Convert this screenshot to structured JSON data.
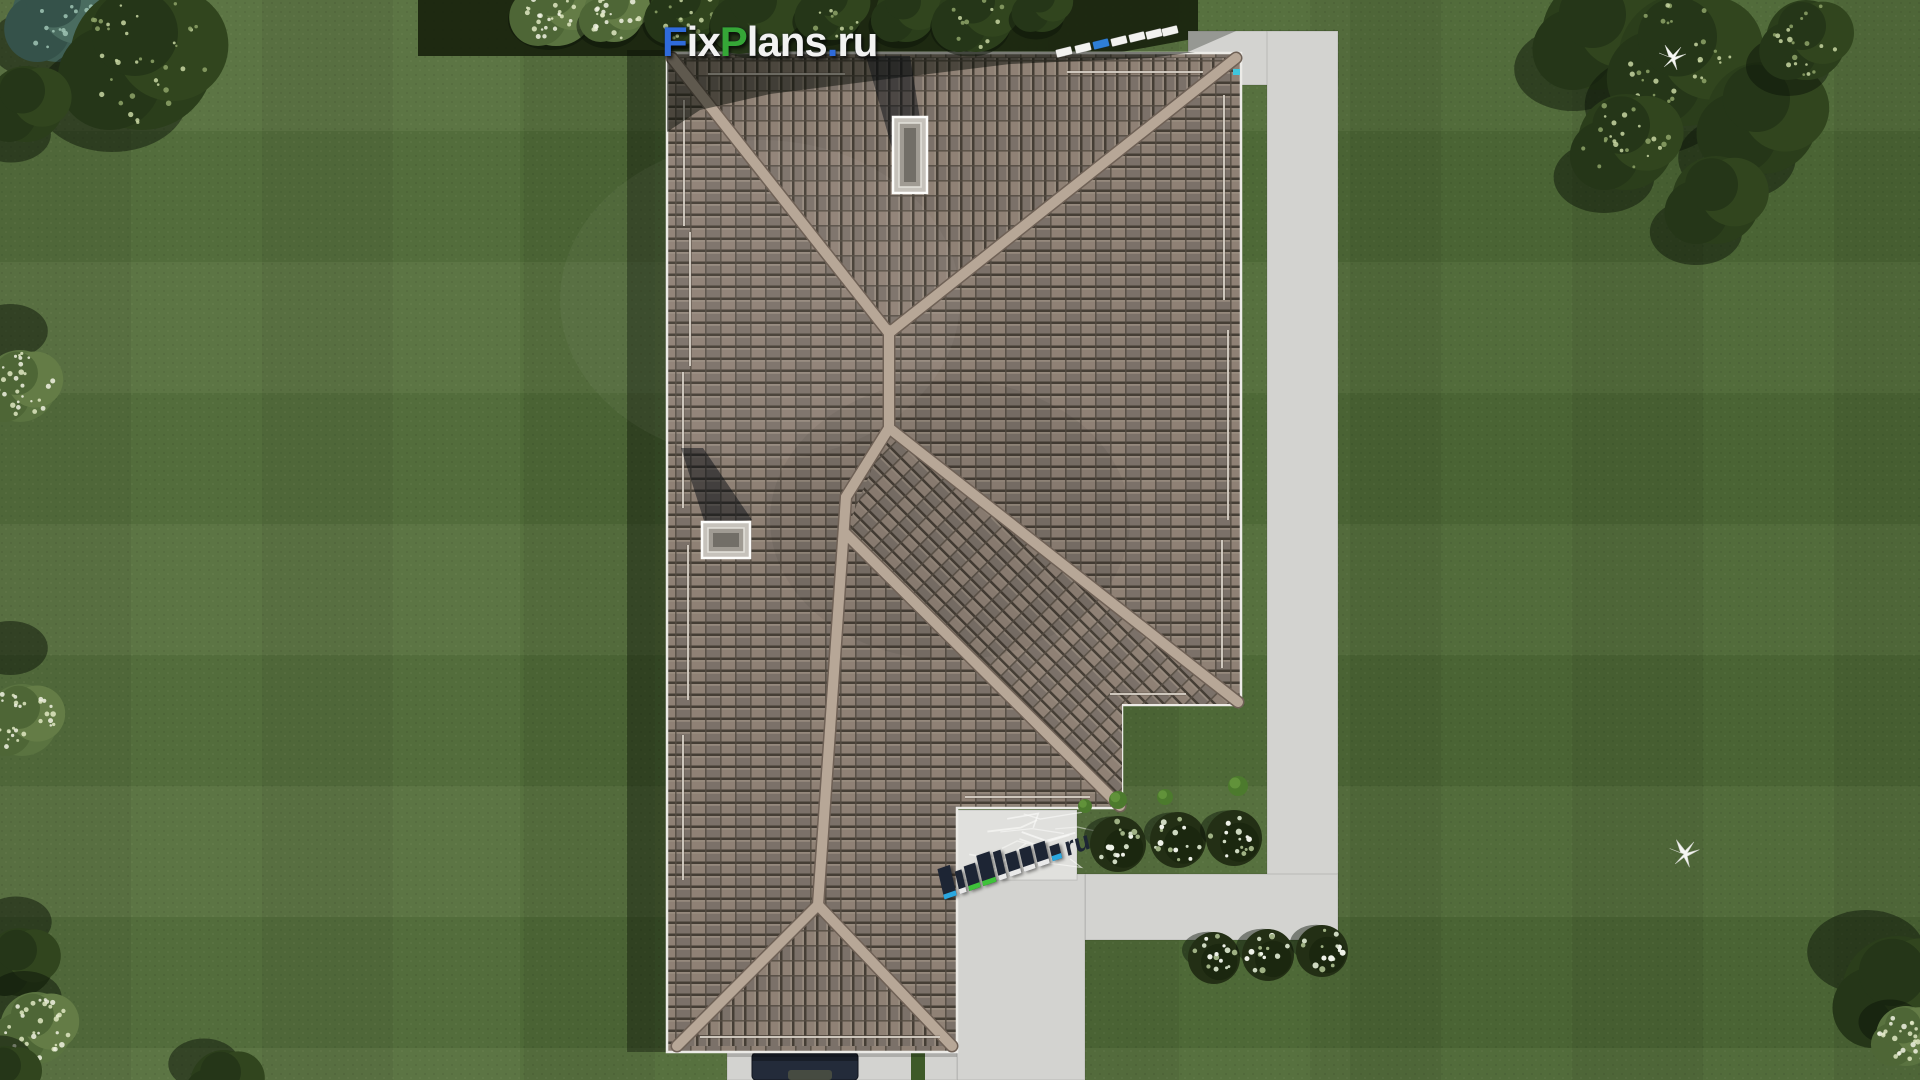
{
  "watermark_top": {
    "part_f": "F",
    "part_ix": "ix",
    "part_p": "P",
    "part_lans": "lans",
    "part_dot": ".",
    "part_ru": "ru"
  },
  "watermark_bottom": {
    "label": "FixPlans.ru",
    "ru_label": "ru"
  },
  "palette": {
    "wm_blue": "#2f6bdb",
    "wm_green": "#35a637",
    "wm_white": "#f2f2f2",
    "wm3_navy": "#1d2534",
    "wm3_cyan": "#2aa7e0",
    "wm3_green": "#3fc23a",
    "grass": "#4e6937",
    "grass_shadow_band": "#1a250f",
    "concrete": "#d3d3d0",
    "terrace": "#e0e0dd",
    "roof_tile": "#87796d",
    "ridge": "#b7a797",
    "fascia": "#ecebe7",
    "chimney": "#c6c2bb",
    "car": "#232b3a",
    "hedge": "#3e5a28"
  },
  "scene": {
    "trees": [
      {
        "x": 58,
        "y": 16,
        "r": 46,
        "t": "teal",
        "sdx": -20,
        "sdy": 28
      },
      {
        "x": 142,
        "y": 58,
        "r": 72,
        "t": "darkspeck",
        "sdx": -30,
        "sdy": 40
      },
      {
        "x": 26,
        "y": 104,
        "r": 38,
        "t": "dark",
        "sdx": -15,
        "sdy": 30
      },
      {
        "x": 556,
        "y": 6,
        "r": 40,
        "t": "speck",
        "sdx": -6,
        "sdy": 14
      },
      {
        "x": 614,
        "y": 12,
        "r": 30,
        "t": "speck",
        "sdx": -6,
        "sdy": 14
      },
      {
        "x": 684,
        "y": 10,
        "r": 34,
        "t": "darkspeck",
        "sdx": -6,
        "sdy": 14
      },
      {
        "x": 757,
        "y": 14,
        "r": 40,
        "t": "dark",
        "sdx": -6,
        "sdy": 14
      },
      {
        "x": 832,
        "y": 8,
        "r": 32,
        "t": "darkspeck",
        "sdx": -6,
        "sdy": 14
      },
      {
        "x": 906,
        "y": 12,
        "r": 30,
        "t": "dark",
        "sdx": -6,
        "sdy": 14
      },
      {
        "x": 976,
        "y": 14,
        "r": 38,
        "t": "darkspeck",
        "sdx": -6,
        "sdy": 14
      },
      {
        "x": 1042,
        "y": 6,
        "r": 26,
        "t": "dark",
        "sdx": -6,
        "sdy": 14
      },
      {
        "x": 1598,
        "y": 34,
        "r": 56,
        "t": "dark",
        "sdx": -25,
        "sdy": 35
      },
      {
        "x": 1684,
        "y": 60,
        "r": 66,
        "t": "darkspeck",
        "sdx": -30,
        "sdy": 45
      },
      {
        "x": 1762,
        "y": 118,
        "r": 56,
        "t": "dark",
        "sdx": -25,
        "sdy": 40
      },
      {
        "x": 1626,
        "y": 142,
        "r": 48,
        "t": "darkspeck",
        "sdx": -22,
        "sdy": 35
      },
      {
        "x": 1716,
        "y": 200,
        "r": 44,
        "t": "dark",
        "sdx": -20,
        "sdy": 32
      },
      {
        "x": 1806,
        "y": 40,
        "r": 40,
        "t": "darkspeck",
        "sdx": -18,
        "sdy": 26
      },
      {
        "x": 20,
        "y": 386,
        "r": 36,
        "t": "speck",
        "sdx": -10,
        "sdy": -55
      },
      {
        "x": 22,
        "y": 720,
        "r": 36,
        "t": "speck",
        "sdx": -12,
        "sdy": -72
      },
      {
        "x": 20,
        "y": 962,
        "r": 34,
        "t": "dark",
        "sdx": -4,
        "sdy": -40
      },
      {
        "x": 36,
        "y": 1028,
        "r": 36,
        "t": "speck",
        "sdx": -12,
        "sdy": -30
      },
      {
        "x": 6,
        "y": 1076,
        "r": 30,
        "t": "dark",
        "sdx": -6,
        "sdy": -18
      },
      {
        "x": 224,
        "y": 1084,
        "r": 34,
        "t": "dark",
        "sdx": -20,
        "sdy": -20
      },
      {
        "x": 1898,
        "y": 992,
        "r": 56,
        "t": "dark",
        "sdx": -32,
        "sdy": -40
      },
      {
        "x": 1906,
        "y": 1036,
        "r": 30,
        "t": "speck",
        "sdx": -16,
        "sdy": -14
      }
    ],
    "flower_bushes": [
      {
        "x": 1118,
        "y": 844,
        "r": 28
      },
      {
        "x": 1178,
        "y": 840,
        "r": 28
      },
      {
        "x": 1234,
        "y": 838,
        "r": 28
      },
      {
        "x": 1214,
        "y": 958,
        "r": 26
      },
      {
        "x": 1268,
        "y": 955,
        "r": 26
      },
      {
        "x": 1322,
        "y": 951,
        "r": 26
      }
    ],
    "grass_tufts": [
      {
        "x": 1085,
        "y": 806,
        "r": 7
      },
      {
        "x": 1118,
        "y": 800,
        "r": 9
      },
      {
        "x": 1165,
        "y": 797,
        "r": 8
      },
      {
        "x": 1238,
        "y": 786,
        "r": 10
      }
    ],
    "birds": [
      {
        "x": 1672,
        "y": 58,
        "s": 1.0
      },
      {
        "x": 1684,
        "y": 854,
        "s": 1.1
      }
    ],
    "roof_slabs_watermark": [
      {
        "x": 1056,
        "y": 48,
        "c": "white"
      },
      {
        "x": 1075,
        "y": 44,
        "c": "white"
      },
      {
        "x": 1093,
        "y": 40,
        "c": "blue"
      },
      {
        "x": 1111,
        "y": 37,
        "c": "white"
      },
      {
        "x": 1129,
        "y": 33,
        "c": "white"
      },
      {
        "x": 1146,
        "y": 30,
        "c": "white"
      },
      {
        "x": 1162,
        "y": 27,
        "c": "white"
      }
    ],
    "chimneys": [
      {
        "x": 893,
        "y": 117,
        "w": 34,
        "h": 76
      },
      {
        "x": 702,
        "y": 522,
        "w": 48,
        "h": 36
      }
    ],
    "car": {
      "x": 752,
      "y": 1053,
      "w": 106,
      "h": 27
    }
  }
}
